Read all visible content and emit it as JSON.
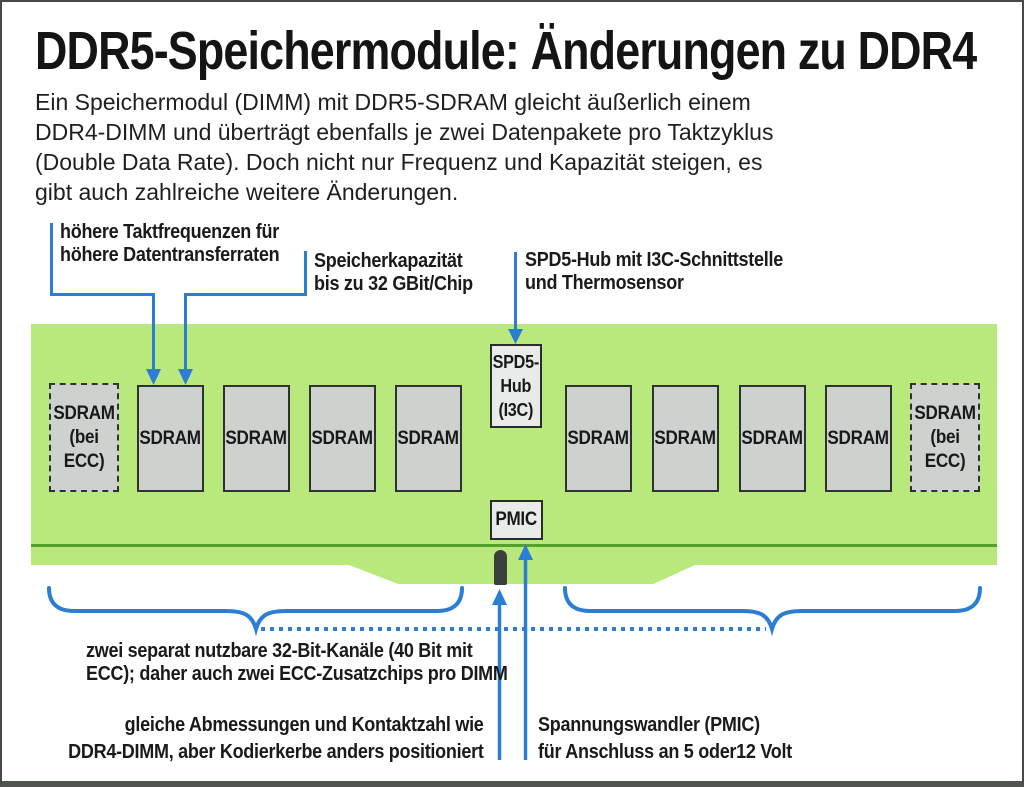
{
  "title": "DDR5-Speichermodule: Änderungen zu DDR4",
  "intro_lines": [
    "Ein Speichermodul (DIMM) mit DDR5-SDRAM gleicht äußerlich einem",
    "DDR4-DIMM und überträgt ebenfalls je zwei Datenpakete pro Taktzyklus",
    "(Double Data Rate). Doch nicht nur Frequenz und Kapazität steigen, es",
    "gibt auch zahlreiche weitere Änderungen."
  ],
  "callouts": {
    "clock": {
      "lines": [
        "höhere Taktfrequenzen für",
        "höhere Datentransferraten"
      ]
    },
    "capacity": {
      "lines": [
        "Speicherkapazität",
        "bis zu 32 GBit/Chip"
      ]
    },
    "spd5": {
      "lines": [
        "SPD5-Hub mit I3C-Schnittstelle",
        "und Thermosensor"
      ]
    },
    "channels": {
      "lines": [
        "zwei separat nutzbare 32-Bit-Kanäle (40 Bit mit",
        "ECC); daher auch zwei ECC-Zusatzchips pro DIMM"
      ]
    },
    "dimensions": {
      "lines": [
        "gleiche Abmessungen und Kontaktzahl wie",
        "DDR4-DIMM, aber Kodierkerbe anders positioniert"
      ]
    },
    "pmic": {
      "lines": [
        "Spannungswandler (PMIC)",
        "für Anschluss an 5 oder12 Volt"
      ]
    }
  },
  "module": {
    "sdram_label": "SDRAM",
    "ecc_chip_lines": [
      "SDRAM",
      "(bei",
      "ECC)"
    ],
    "spd5_hub_lines": [
      "SPD5-",
      "Hub",
      "(I3C)"
    ],
    "pmic_label": "PMIC"
  },
  "colors": {
    "pcb_green": "#b9e87d",
    "edge_green": "#55a02c",
    "accent_blue": "#2b7ed3",
    "chip_gray": "#cdd2ce",
    "io_chip_gray": "#e9ebe8",
    "notch_dark": "#3b403c"
  }
}
